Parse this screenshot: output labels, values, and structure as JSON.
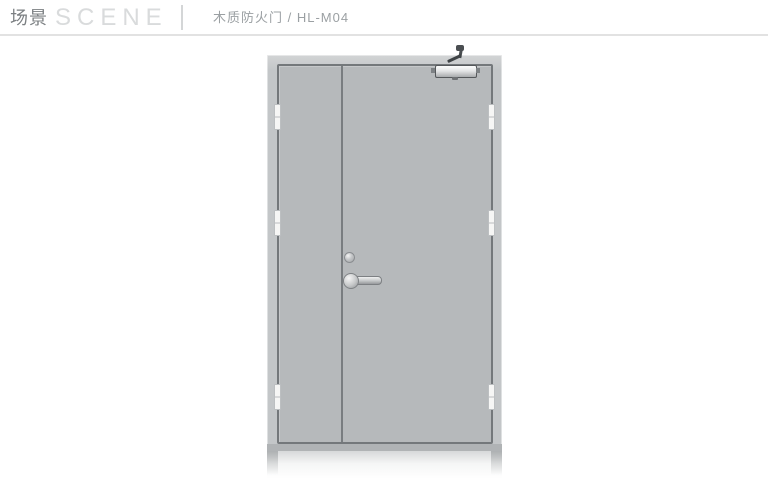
{
  "header": {
    "title_cn": "场景",
    "title_en": "SCENE",
    "product_label": "木质防火门 / HL-M04"
  },
  "colors": {
    "header_border": "#e2e2e2",
    "header_divider": "#d4d6d7",
    "title_cn": "#7b7f82",
    "title_en": "#d9dbdc",
    "product_label": "#9ba0a3",
    "frame_face": "#c3c6c8",
    "frame_top_light": "#d2d4d5",
    "frame_bottom_band": "#b0b3b5",
    "leaf": "#b6b9bb",
    "outline_dark": "#74787b",
    "divider_line": "#797d80",
    "hinge_white": "#f6f6f5",
    "hinge_border": "#bcbfc1",
    "metal_dark": "#4a4e51",
    "closer_outline": "#55585b"
  }
}
